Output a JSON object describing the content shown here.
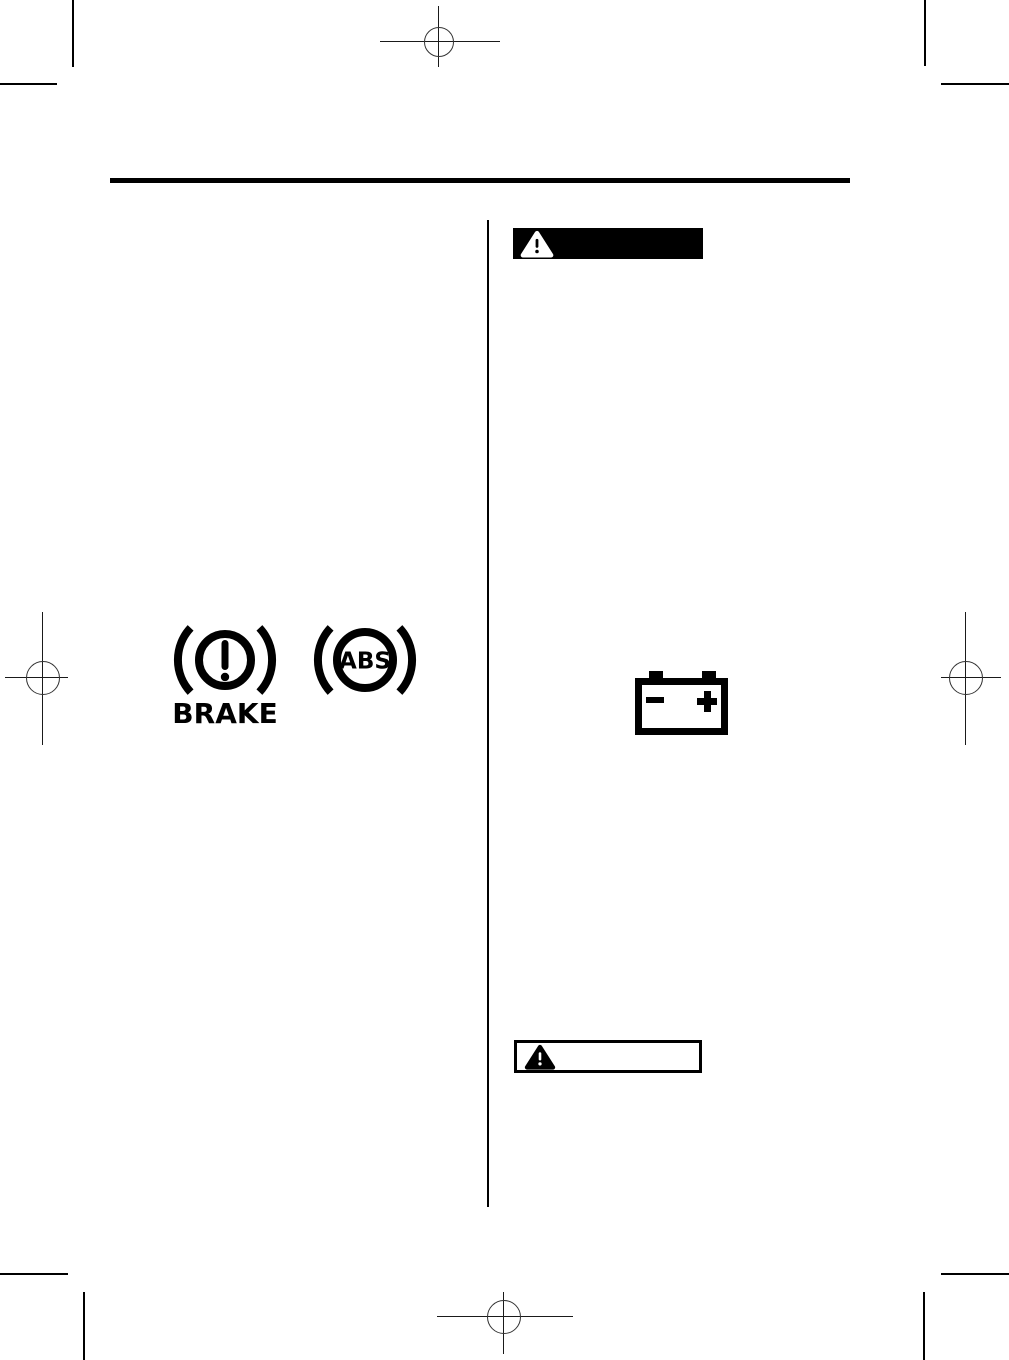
{
  "page": {
    "paper_color": "#ffffff",
    "ink_color": "#000000",
    "kind": "owners-manual-page"
  },
  "left_column": {
    "brake_warning_light": {
      "label": "BRAKE",
      "exclamation": "!"
    },
    "abs_warning_light": {
      "label": "ABS"
    }
  },
  "right_column": {
    "warning_banner": {
      "style_color": "#000000",
      "exclamation": "!"
    },
    "battery_symbol": {
      "negative_terminal": "−",
      "positive_terminal": "+"
    },
    "caution_box": {
      "exclamation": "!"
    }
  }
}
